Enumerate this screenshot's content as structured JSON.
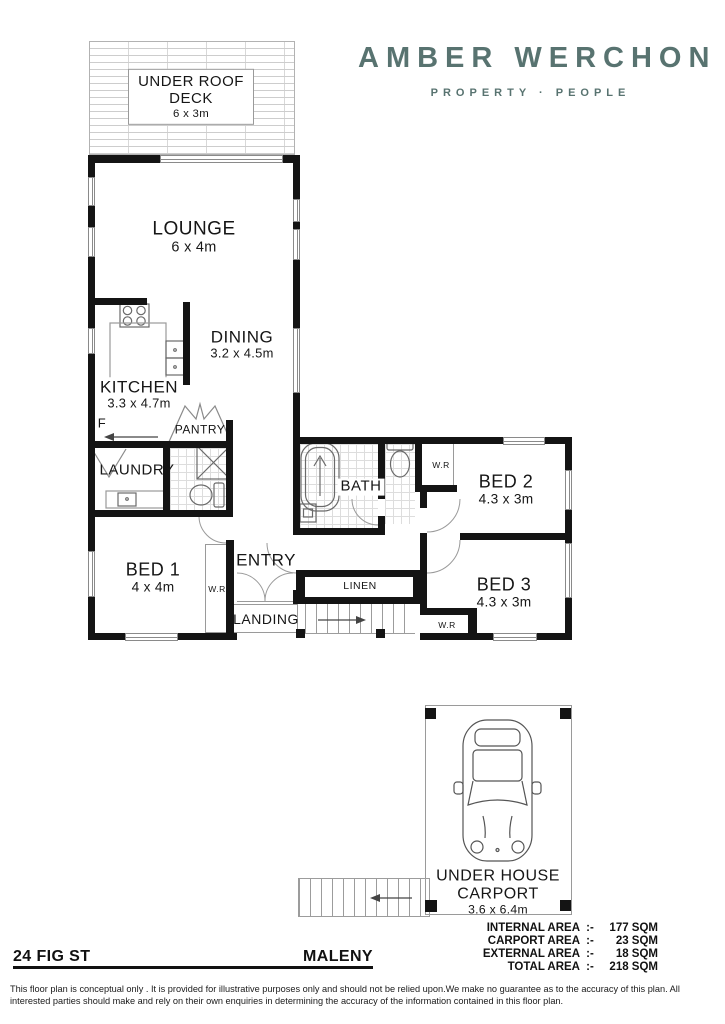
{
  "brand": {
    "name": "AMBER WERCHON",
    "tagline": "PROPERTY · PEOPLE",
    "color": "#587370"
  },
  "rooms": {
    "deck": {
      "label": "UNDER ROOF DECK",
      "dims": "6 x 3m"
    },
    "lounge": {
      "label": "LOUNGE",
      "dims": "6 x 4m"
    },
    "dining": {
      "label": "DINING",
      "dims": "3.2 x 4.5m"
    },
    "kitchen": {
      "label": "KITCHEN",
      "dims": "3.3 x 4.7m"
    },
    "pantry": {
      "label": "PANTRY"
    },
    "fridge": {
      "label": "F"
    },
    "laundry": {
      "label": "LAUNDRY"
    },
    "bath": {
      "label": "BATH"
    },
    "entry": {
      "label": "ENTRY"
    },
    "landing": {
      "label": "LANDING"
    },
    "linen": {
      "label": "LINEN"
    },
    "bed1": {
      "label": "BED 1",
      "dims": "4 x 4m"
    },
    "bed2": {
      "label": "BED 2",
      "dims": "4.3 x 3m"
    },
    "bed3": {
      "label": "BED 3",
      "dims": "4.3 x 3m"
    },
    "wr": {
      "label": "W.R"
    },
    "carport": {
      "label": "UNDER HOUSE CARPORT",
      "dims": "3.6 x 6.4m"
    }
  },
  "footer": {
    "address": "24 FIG ST",
    "suburb": "MALENY",
    "areas": [
      {
        "label": "INTERNAL AREA",
        "sep": ":-",
        "value": "177 SQM"
      },
      {
        "label": "CARPORT AREA",
        "sep": ":-",
        "value": "23 SQM"
      },
      {
        "label": "EXTERNAL AREA",
        "sep": ":-",
        "value": "18 SQM"
      },
      {
        "label": "TOTAL AREA",
        "sep": ":-",
        "value": "218 SQM"
      }
    ],
    "disclaimer": "This floor plan is conceptual only . It is provided for illustrative purposes only and should not be relied upon.We make no guarantee as to the accuracy of this plan. All interested parties should make and rely on their own enquiries in determining the accuracy of the information contained in this floor plan."
  }
}
